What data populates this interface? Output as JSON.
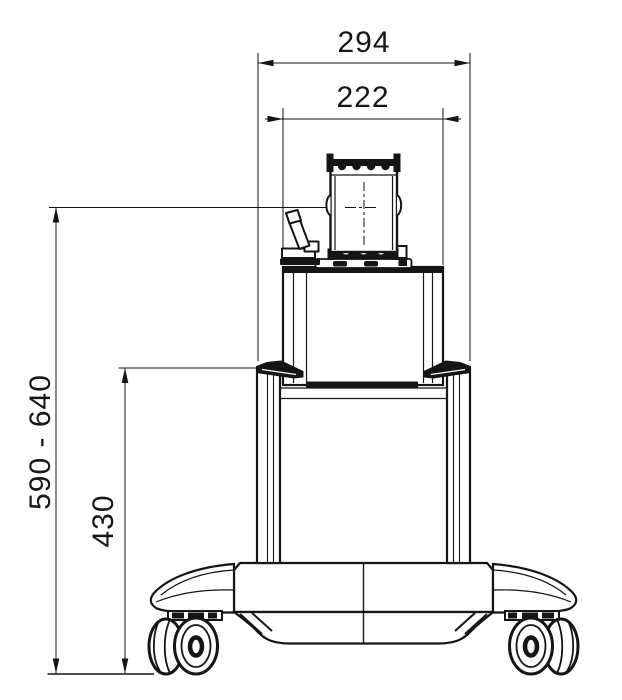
{
  "drawing": {
    "kind": "front-view dimensional drawing of wheeled equipment cart",
    "dimensions": {
      "width_outer": "294",
      "width_inner": "222",
      "height_overall": "590 - 640",
      "height_column": "430"
    },
    "colors": {
      "line": "#151515",
      "background": "#ffffff"
    }
  }
}
